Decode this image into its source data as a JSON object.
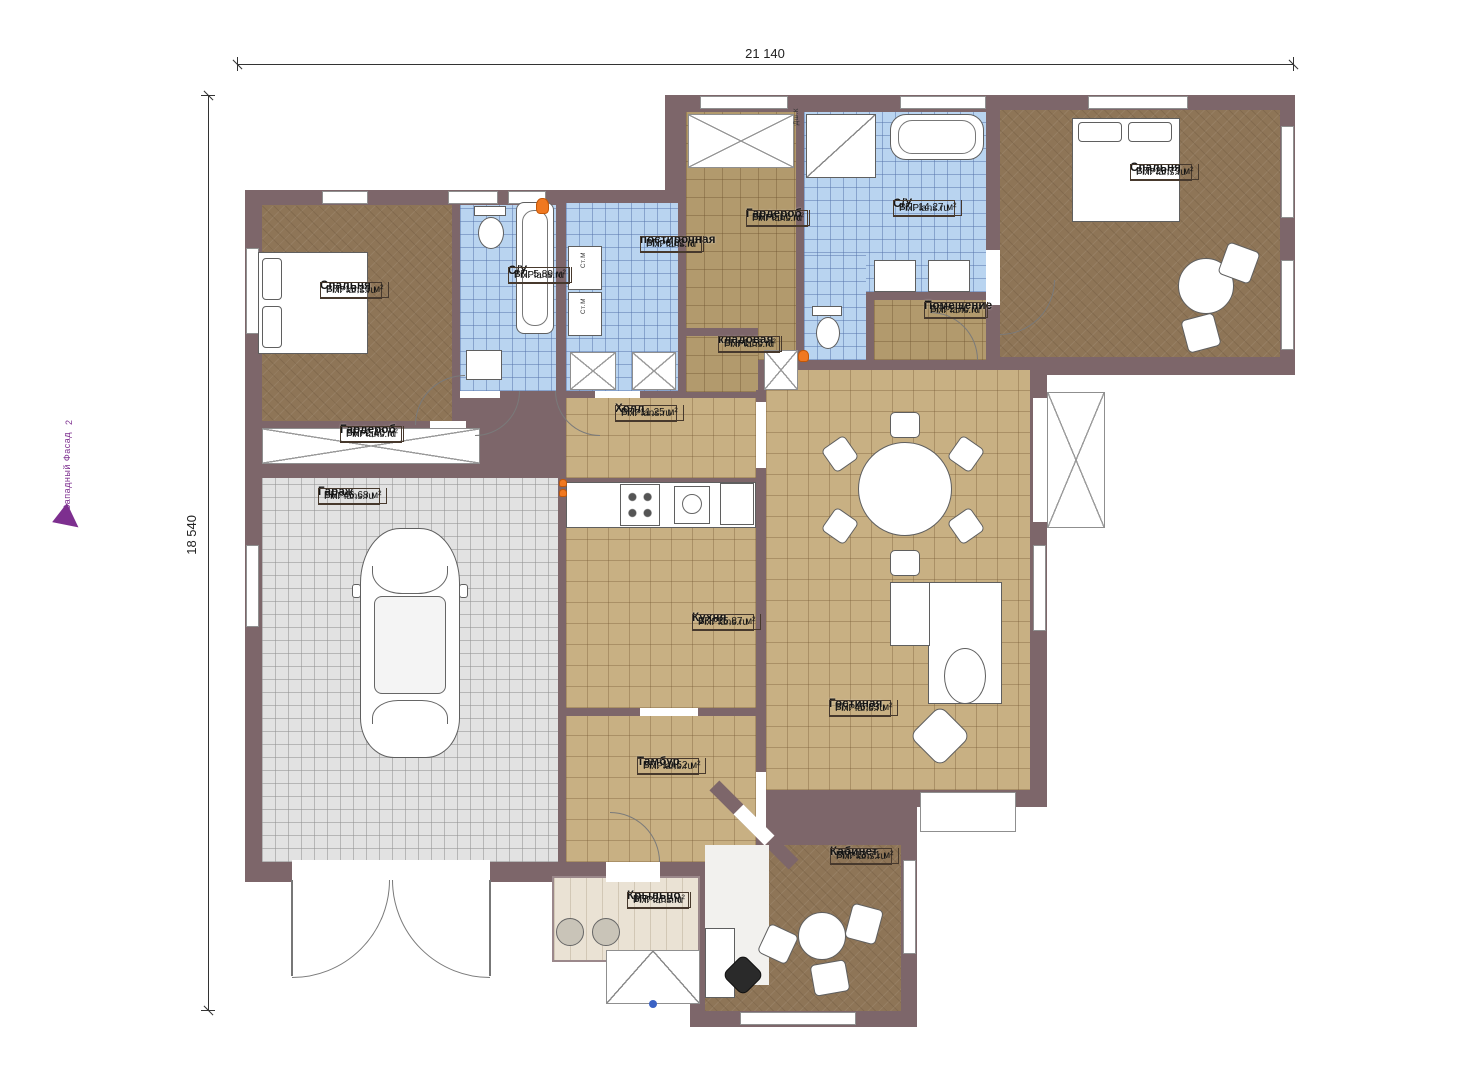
{
  "dimensions": {
    "top": "21 140",
    "left": "18 540"
  },
  "facade": {
    "label": "Западный Фасад",
    "number": "2"
  },
  "brand": "FixPlans.ru",
  "rooms": [
    {
      "name": "Спальня",
      "area": "ВП: 15,26 м²"
    },
    {
      "name": "С/У",
      "area": "ВП: 5,89 м²"
    },
    {
      "name": "постирочная",
      "area": "ВП: 6,82 м²"
    },
    {
      "name": "Гардероб",
      "area": "ВП: 9,56 м²"
    },
    {
      "name": "С/У",
      "area": "ВП: 14,27 м²"
    },
    {
      "name": "Спальня",
      "area": "ВП: 26,79 м²"
    },
    {
      "name": "Помещение",
      "area": "ВП: 2,76 м²"
    },
    {
      "name": "кладовая",
      "area": "ВП: 1,56 м²"
    },
    {
      "name": "Холл",
      "area": "ВП: 11,25 м²"
    },
    {
      "name": "Гардероб",
      "area": "ВП: 2,40 м²"
    },
    {
      "name": "Гараж",
      "area": "ВП: 46,68 м²"
    },
    {
      "name": "Кухня",
      "area": "ВП: 15,87 м²"
    },
    {
      "name": "Гостиная",
      "area": "ВП: 45,83 м²"
    },
    {
      "name": "Тамбур",
      "area": "ВП: 10,52 м²"
    },
    {
      "name": "Кабинет",
      "area": "ВП: 13,71 м²"
    },
    {
      "name": "Крыльцо",
      "area": "ВП: 3,82 м²"
    }
  ],
  "fixtures": {
    "washer_1": "Ст.М",
    "washer_2": "Ст.М",
    "shower_cabin": "Дш.К"
  },
  "colors": {
    "wall": "#7d666a",
    "floor_wood": "#8e7557",
    "floor_tile": "#c8b083",
    "floor_wet": "#b9d4f0",
    "floor_garage": "#e2e2e2",
    "accent_purple": "#7d2f8f",
    "flame": "#f07820"
  }
}
